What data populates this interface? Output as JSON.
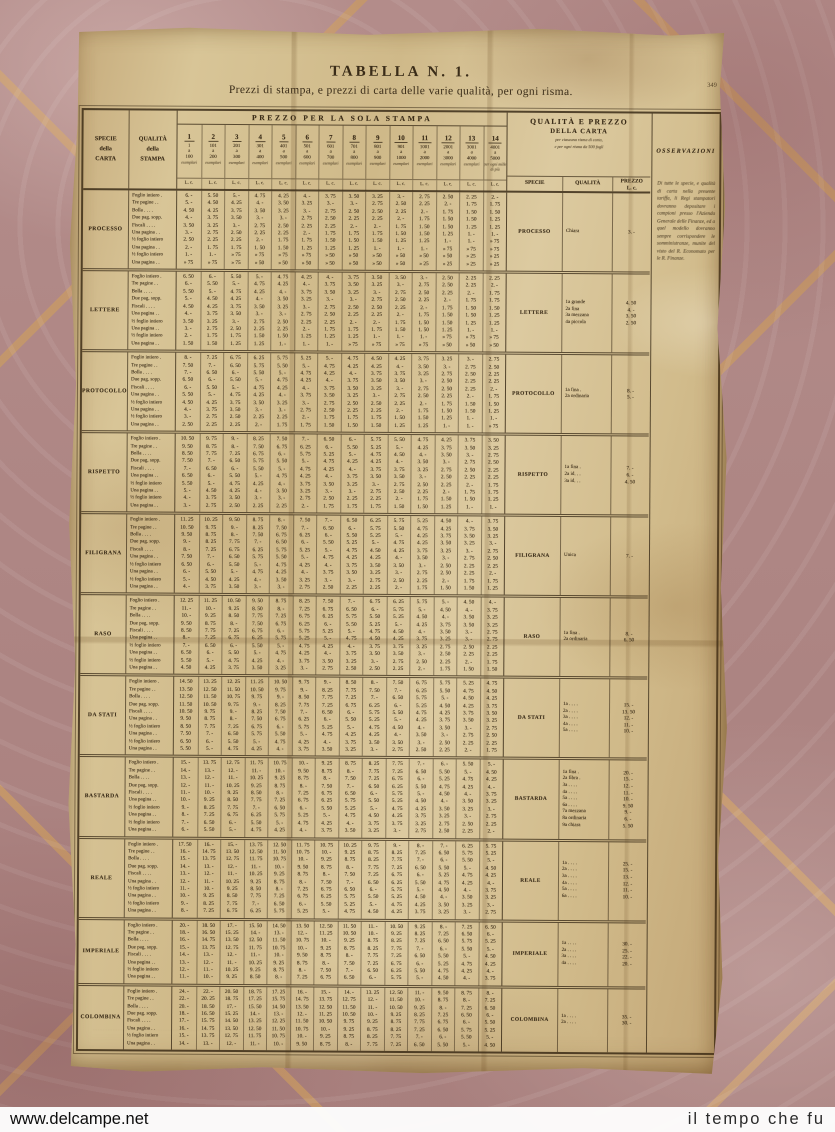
{
  "page": {
    "number": "349",
    "title": "TABELLA N. 1.",
    "subtitle": "Prezzi di stampa, e prezzi di carta delle varie qualità, per ogni risma."
  },
  "stampa": {
    "specie_header": "SPECIE\ndella\nCARTA",
    "qualita_header": "QUALITÀ\ndella\nSTAMPA",
    "banner": "PREZZO PER LA SOLA STAMPA",
    "unit": "L. c.",
    "columns": [
      {
        "n": "1",
        "from": "1",
        "to": "100",
        "cap": "esemplari"
      },
      {
        "n": "2",
        "from": "101",
        "to": "200",
        "cap": "esemplari"
      },
      {
        "n": "3",
        "from": "201",
        "to": "300",
        "cap": "esemplari"
      },
      {
        "n": "4",
        "from": "301",
        "to": "400",
        "cap": "esemplari"
      },
      {
        "n": "5",
        "from": "401",
        "to": "500",
        "cap": "esemplari"
      },
      {
        "n": "6",
        "from": "501",
        "to": "600",
        "cap": "esemplari"
      },
      {
        "n": "7",
        "from": "601",
        "to": "700",
        "cap": "esemplari"
      },
      {
        "n": "8",
        "from": "701",
        "to": "800",
        "cap": "esemplari"
      },
      {
        "n": "9",
        "from": "801",
        "to": "900",
        "cap": "esemplari"
      },
      {
        "n": "10",
        "from": "901",
        "to": "1000",
        "cap": "esemplari"
      },
      {
        "n": "11",
        "from": "1001",
        "to": "2000",
        "cap": "esemplari"
      },
      {
        "n": "12",
        "from": "2001",
        "to": "3000",
        "cap": "esemplari"
      },
      {
        "n": "13",
        "from": "3001",
        "to": "4000",
        "cap": "esemplari"
      },
      {
        "n": "14",
        "from": "4001",
        "to": "5000",
        "cap": "per ogni mille di più"
      }
    ],
    "row_labels": [
      "Foglio intiero .",
      "Tre pagine . .",
      "Bolla . . . .",
      "Due pag. sopp.",
      "Fiscali . . . .",
      "Una pagina . .",
      "½ foglio intiero",
      "Una pagina . .",
      "½ foglio intiero",
      "Una pagina . ."
    ],
    "col_factors": [
      1,
      0.92,
      0.85,
      0.78,
      0.72,
      0.67,
      0.62,
      0.58,
      0.55,
      0.52,
      0.46,
      0.4,
      0.36,
      0.33
    ],
    "groups": [
      {
        "name": "PROCESSO",
        "bases": [
          6,
          5,
          4.5,
          4,
          3.5,
          3,
          2.5,
          2,
          1,
          0.75
        ]
      },
      {
        "name": "LETTERE",
        "bases": [
          6.5,
          6,
          5.5,
          5,
          4.5,
          4,
          3.5,
          3,
          2,
          1.5
        ]
      },
      {
        "name": "PROTOCOLLO",
        "bases": [
          8,
          7.5,
          7,
          6.5,
          6,
          5.5,
          4.5,
          4,
          3,
          2.5
        ]
      },
      {
        "name": "RISPETTO",
        "bases": [
          10.5,
          9.5,
          8.5,
          7.5,
          7,
          6.5,
          5.5,
          5,
          4,
          3
        ]
      },
      {
        "name": "FILIGRANA",
        "bases": [
          11.25,
          10.5,
          9.5,
          9,
          8,
          7.5,
          6.5,
          6,
          5,
          4
        ]
      },
      {
        "name": "RASO",
        "bases": [
          12.25,
          11,
          10,
          9.5,
          8.5,
          8,
          7,
          6.5,
          5.5,
          4.5
        ]
      },
      {
        "name": "DA STATI",
        "bases": [
          14.5,
          13.5,
          12.5,
          11.5,
          10.5,
          9.5,
          8.5,
          7.5,
          6.5,
          5.5
        ]
      },
      {
        "name": "BASTARDA",
        "bases": [
          15,
          14,
          13,
          12,
          11,
          10,
          9,
          8,
          7,
          6
        ]
      },
      {
        "name": "REALE",
        "bases": [
          17.5,
          16,
          15,
          14,
          13,
          12,
          11,
          10,
          9,
          8
        ]
      },
      {
        "name": "IMPERIALE",
        "bases": [
          20,
          18,
          16,
          15,
          14,
          13,
          12,
          11
        ]
      },
      {
        "name": "COLOMBINA",
        "bases": [
          24,
          22,
          20,
          18,
          17,
          16,
          15,
          14
        ]
      }
    ]
  },
  "carta": {
    "title1": "QUALITÀ E PREZZO",
    "title2": "DELLA CARTA",
    "note1": "per ciascuna risma di carta,",
    "note2": "e per ogni risma da 500 fogli",
    "col_specie": "SPECIE",
    "col_qualita": "QUALITÀ",
    "col_prezzo": "PREZZO\nL. c.",
    "entries": [
      {
        "name": "PROCESSO",
        "lines": [
          [
            "Chiara",
            "3. -"
          ]
        ]
      },
      {
        "name": "LETTERE",
        "lines": [
          [
            "1a grande",
            "4. 50"
          ],
          [
            "2a fina",
            "4. -"
          ],
          [
            "3a mezzana",
            "3. 50"
          ],
          [
            "4a piccola",
            "2. 50"
          ]
        ]
      },
      {
        "name": "PROTOCOLLO",
        "lines": [
          [
            "1a fina .",
            "8. -"
          ],
          [
            "2a ordinaria",
            "5. -"
          ]
        ]
      },
      {
        "name": "RISPETTO",
        "lines": [
          [
            "1a fina .",
            "7. -"
          ],
          [
            "2a id. . .",
            "6. -"
          ],
          [
            "3a id. . .",
            "4. 50"
          ]
        ]
      },
      {
        "name": "FILIGRANA",
        "lines": [
          [
            "Unica",
            "7. -"
          ]
        ]
      },
      {
        "name": "RASO",
        "lines": [
          [
            "1a fina .",
            "8. -"
          ],
          [
            "2a ordinaria",
            "6. 50"
          ]
        ]
      },
      {
        "name": "DA STATI",
        "lines": [
          [
            "1a . . . .",
            "15. -"
          ],
          [
            "2a . . . .",
            "13. 50"
          ],
          [
            "3a . . . .",
            "12. -"
          ],
          [
            "4a . . . .",
            "11. -"
          ],
          [
            "5a . . . .",
            "10. -"
          ]
        ]
      },
      {
        "name": "BASTARDA",
        "lines": [
          [
            "1a fina .",
            "20. -"
          ],
          [
            "2a fibra .",
            "15. -"
          ],
          [
            "3a . . . .",
            "12. -"
          ],
          [
            "4a . . . .",
            "11. -"
          ],
          [
            "5a . . . .",
            "10. -"
          ],
          [
            "6a . . . .",
            "9. 50"
          ],
          [
            "7a mezzana",
            "9. -"
          ],
          [
            "8a ordinaria",
            "6. -"
          ],
          [
            "9a chiara",
            "5. 50"
          ]
        ]
      },
      {
        "name": "REALE",
        "lines": [
          [
            "1a . . . .",
            "25. -"
          ],
          [
            "2a . . . .",
            "15. -"
          ],
          [
            "3a . . . .",
            "13. -"
          ],
          [
            "4a . . . .",
            "12. -"
          ],
          [
            "5a . . . .",
            "11. -"
          ],
          [
            "6a . . . .",
            "10. -"
          ]
        ]
      },
      {
        "name": "IMPERIALE",
        "lines": [
          [
            "1a . . . .",
            "30. -"
          ],
          [
            "2a . . . .",
            "25. -"
          ],
          [
            "3a . . . .",
            "22. -"
          ],
          [
            "4a . . . .",
            "20. -"
          ]
        ]
      },
      {
        "name": "COLOMBINA",
        "lines": [
          [
            "1a . . . .",
            "35. -"
          ],
          [
            "2a . . . .",
            "30. -"
          ]
        ]
      }
    ]
  },
  "osservazioni": {
    "header": "OSSERVAZIONI",
    "text": "Di tutte le specie, e qualità di carta nella presente tariffa, li Regi stampatori dovranno depositare i campioni presso l'Azienda Generale delle Finanze, ed a quel modello dovranno sempre corrispondere le somministranze, munite del visto del R. Economato per le R. Finanze."
  },
  "colors": {
    "paper": "#d7c49a",
    "ink": "#3a2c18",
    "floor": "#aa8380",
    "grout": "#c69868",
    "watermark_bg": "#fdfdfd"
  },
  "watermark": {
    "left": "www.delcampe.net",
    "right": "il tempo che fu"
  }
}
